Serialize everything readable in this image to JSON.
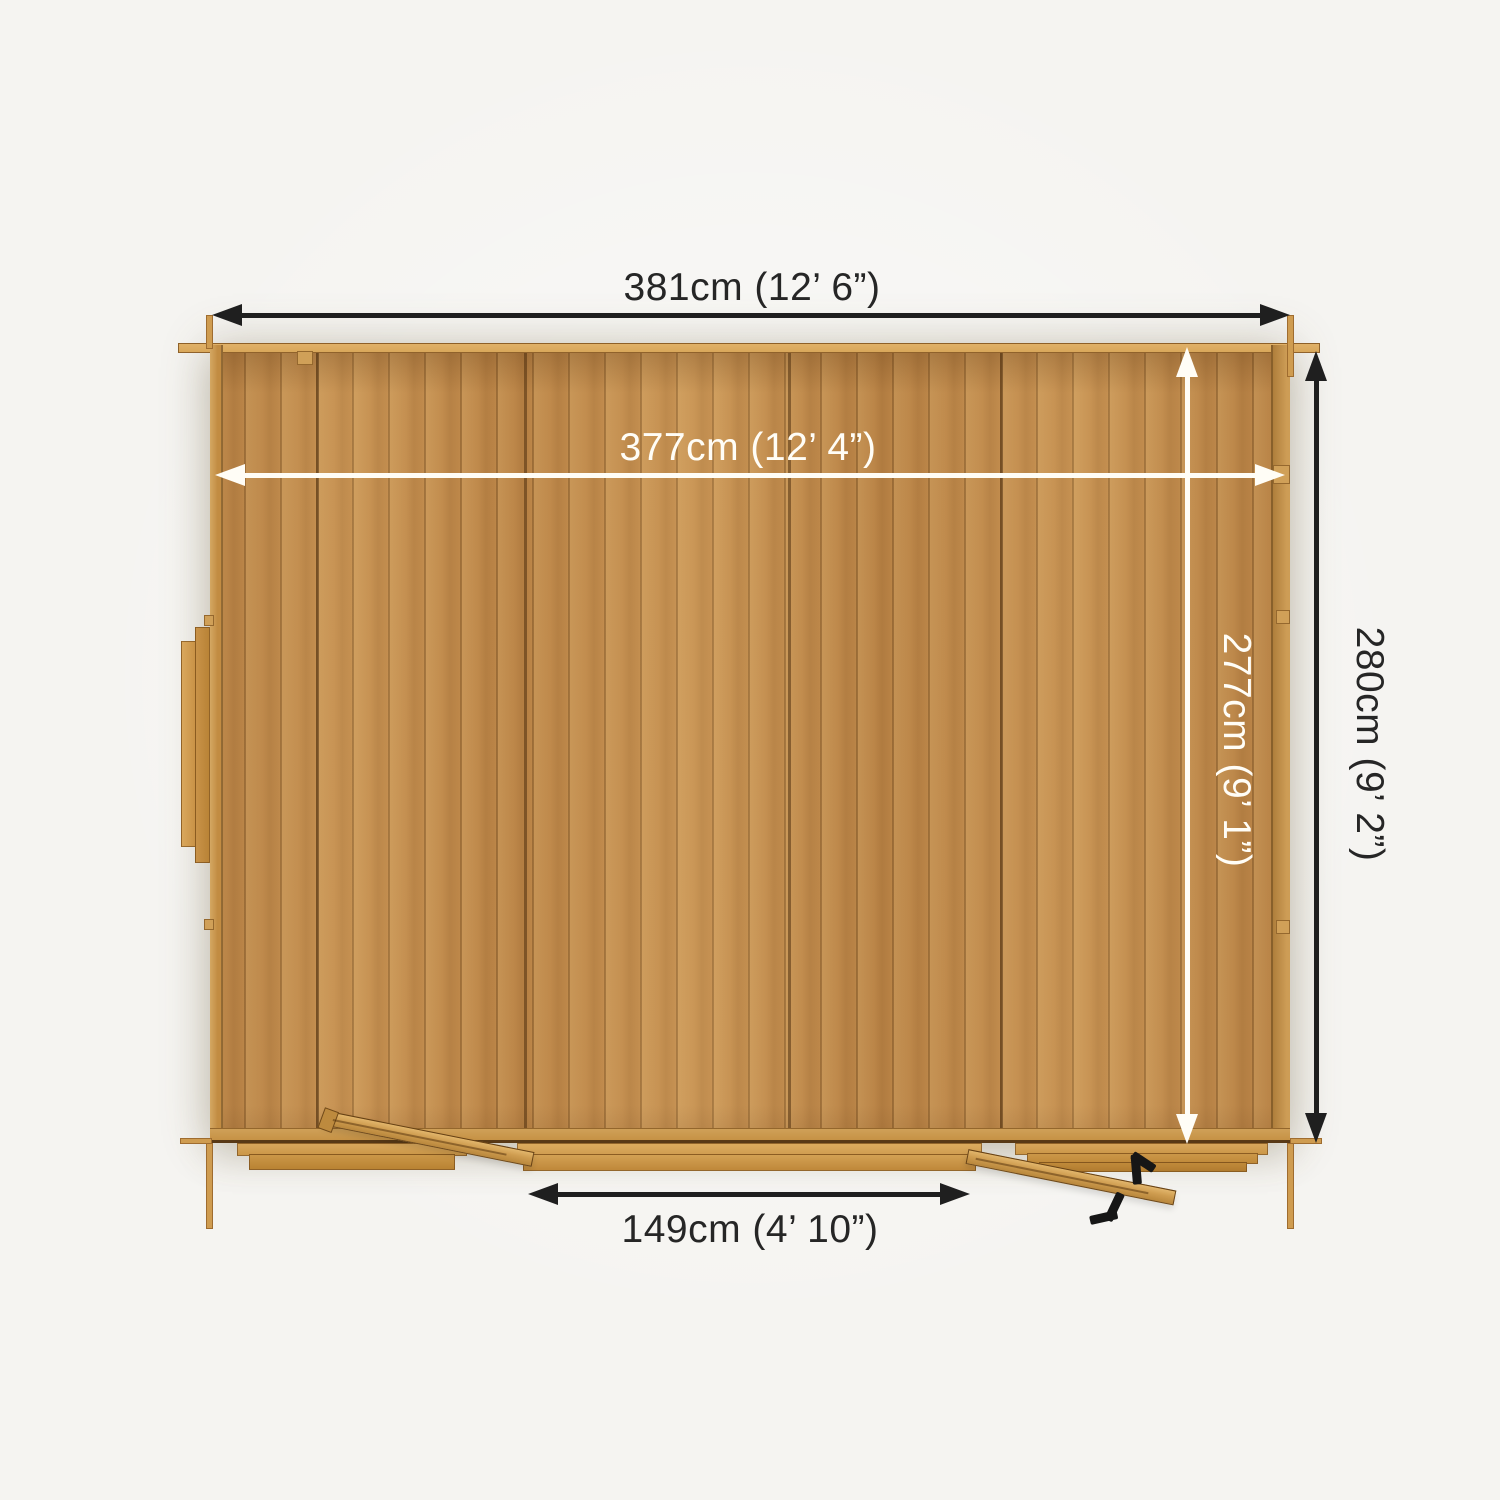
{
  "colors": {
    "background": "#f5f4f1",
    "wood_base": "#c1894a",
    "wood_light": "#d9a75a",
    "arrow_dark": "#1f1f1f",
    "arrow_light": "#fffdf6",
    "text_dark": "#262626",
    "text_light": "#fffdf6",
    "handle": "#161616"
  },
  "dimensions": {
    "outer_width": "381cm (12’ 6”)",
    "inner_width": "377cm (12’ 4”)",
    "outer_depth": "280cm (9’ 2”)",
    "inner_depth": "277cm (9’ 1”)",
    "door_width": "149cm (4’ 10”)"
  }
}
